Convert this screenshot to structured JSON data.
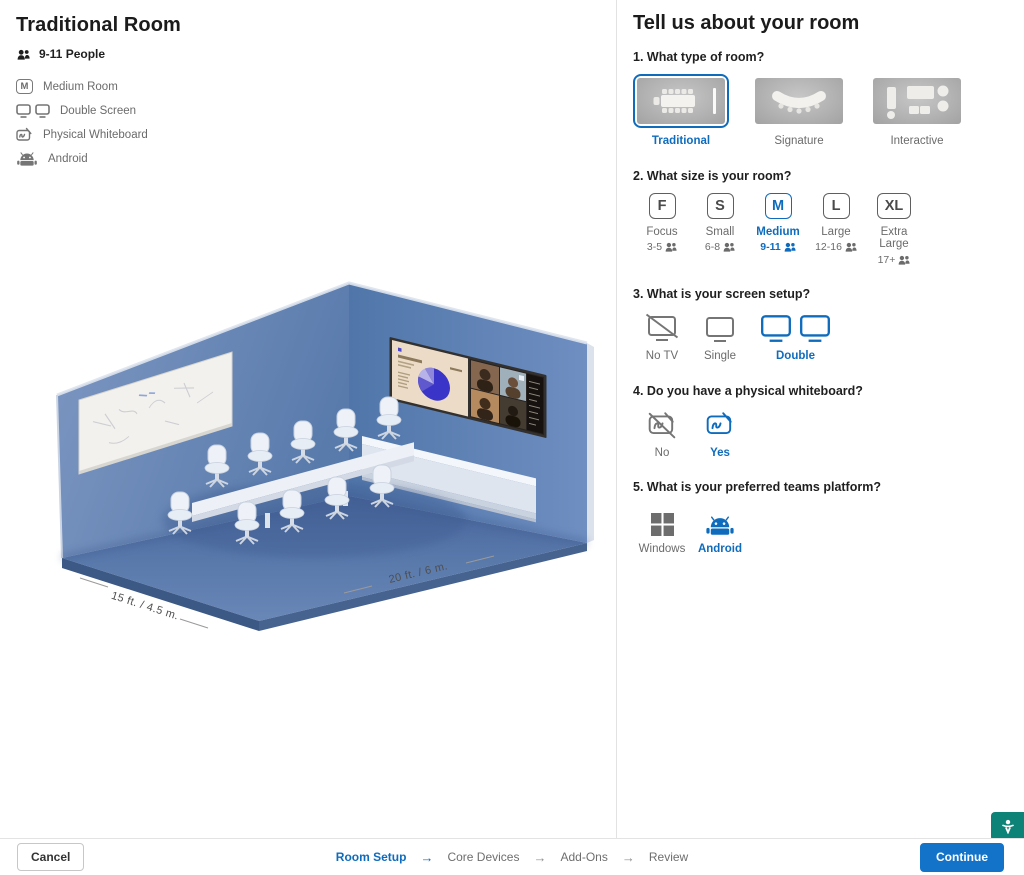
{
  "left": {
    "title": "Traditional Room",
    "capacity": "9-11 People",
    "features": [
      {
        "icon": "room-size-m-icon",
        "icon_letter": "M",
        "label": "Medium Room"
      },
      {
        "icon": "double-screen-icon",
        "label": "Double Screen"
      },
      {
        "icon": "whiteboard-icon",
        "label": "Physical Whiteboard"
      },
      {
        "icon": "android-icon",
        "label": "Android"
      }
    ],
    "room_visual": {
      "dimension_left": "15 ft. / 4.5 m.",
      "dimension_right": "20 ft. / 6 m."
    }
  },
  "right": {
    "title": "Tell us about your room",
    "q1": {
      "heading": "1. What type of room?",
      "options": [
        {
          "label": "Traditional",
          "selected": true
        },
        {
          "label": "Signature",
          "selected": false
        },
        {
          "label": "Interactive",
          "selected": false
        }
      ]
    },
    "q2": {
      "heading": "2. What size is your room?",
      "options": [
        {
          "letter": "F",
          "label": "Focus",
          "capacity": "3-5",
          "selected": false
        },
        {
          "letter": "S",
          "label": "Small",
          "capacity": "6-8",
          "selected": false
        },
        {
          "letter": "M",
          "label": "Medium",
          "capacity": "9-11",
          "selected": true
        },
        {
          "letter": "L",
          "label": "Large",
          "capacity": "12-16",
          "selected": false
        },
        {
          "letter": "XL",
          "label": "Extra Large",
          "capacity": "17+",
          "selected": false
        }
      ]
    },
    "q3": {
      "heading": "3. What is your screen setup?",
      "options": [
        {
          "label": "No TV",
          "selected": false
        },
        {
          "label": "Single",
          "selected": false
        },
        {
          "label": "Double",
          "selected": true
        }
      ]
    },
    "q4": {
      "heading": "4. Do you have a physical whiteboard?",
      "options": [
        {
          "label": "No",
          "selected": false
        },
        {
          "label": "Yes",
          "selected": true
        }
      ]
    },
    "q5": {
      "heading": "5. What is your preferred teams platform?",
      "options": [
        {
          "label": "Windows",
          "selected": false
        },
        {
          "label": "Android",
          "selected": true
        }
      ]
    }
  },
  "footer": {
    "cancel_label": "Cancel",
    "continue_label": "Continue",
    "steps": [
      "Room Setup",
      "Core Devices",
      "Add-Ons",
      "Review"
    ],
    "active_step": "Room Setup"
  },
  "colors": {
    "accent": "#0f6cbd",
    "continue_button": "#1373c9",
    "a11y_teal": "#0d8276"
  }
}
